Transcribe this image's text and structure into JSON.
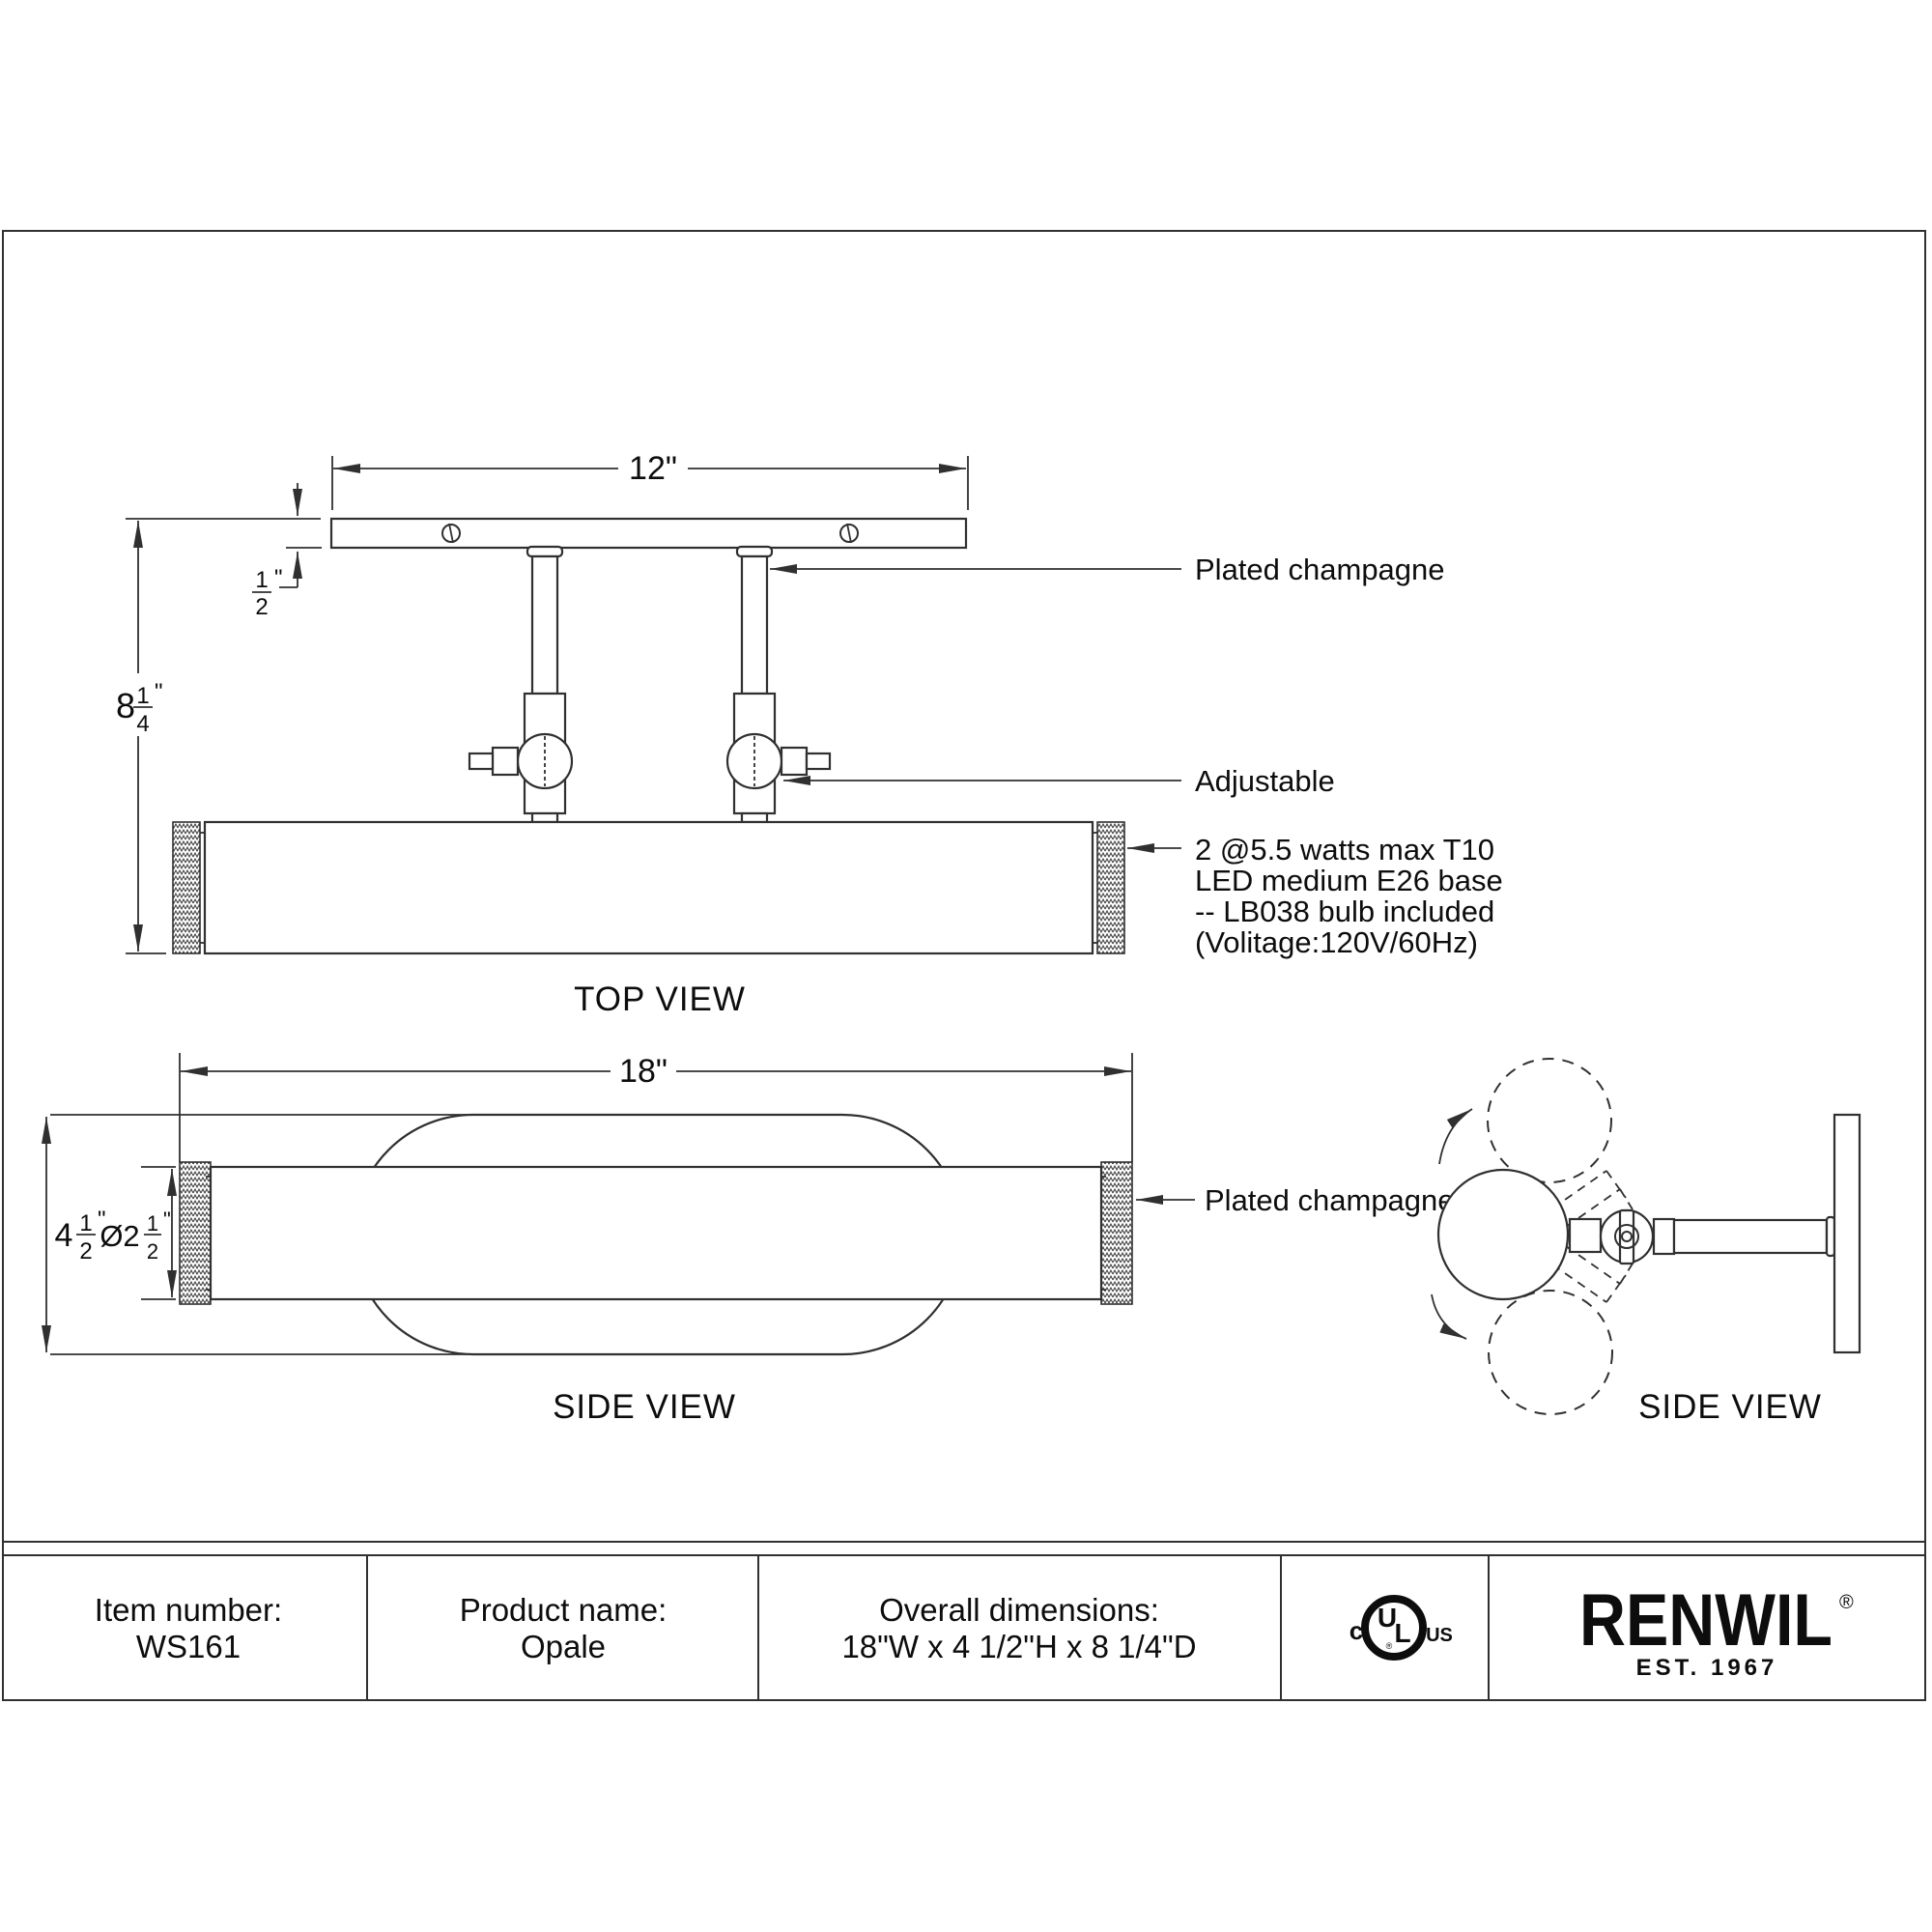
{
  "colors": {
    "line": "#303030",
    "text": "#0d0d0d",
    "bg": "#ffffff"
  },
  "top_view": {
    "label": "TOP VIEW",
    "dims": {
      "width": "12\"",
      "thickness": {
        "num": "1",
        "den": "2",
        "unit": "\""
      },
      "height": {
        "whole": "8",
        "num": "1",
        "den": "4",
        "unit": "\""
      }
    },
    "annotations": {
      "plated": "Plated champagne",
      "adjustable": "Adjustable",
      "bulb": [
        "2 @5.5 watts max T10",
        "LED medium E26 base",
        "-- LB038 bulb included",
        "(Volitage:120V/60Hz)"
      ]
    }
  },
  "side_view": {
    "label": "SIDE VIEW",
    "dims": {
      "width": "18\"",
      "height": {
        "whole": "4",
        "num": "1",
        "den": "2",
        "unit": "\""
      },
      "diameter": {
        "whole": "Ø2",
        "num": "1",
        "den": "2",
        "unit": "\""
      }
    },
    "annotations": {
      "plated": "Plated champagne"
    }
  },
  "rotation_view": {
    "label": "SIDE VIEW"
  },
  "footer": {
    "item": {
      "label": "Item number:",
      "value": "WS161"
    },
    "product": {
      "label": "Product name:",
      "value": "Opale"
    },
    "dimensions": {
      "label": "Overall dimensions:",
      "value": "18\"W x 4 1/2\"H x 8 1/4\"D"
    },
    "certification": {
      "c": "c",
      "u": "U",
      "l": "L",
      "us": "US",
      "reg": "®"
    },
    "brand": {
      "name": "RENWIL",
      "reg": "®",
      "est": "EST. 1967"
    }
  }
}
